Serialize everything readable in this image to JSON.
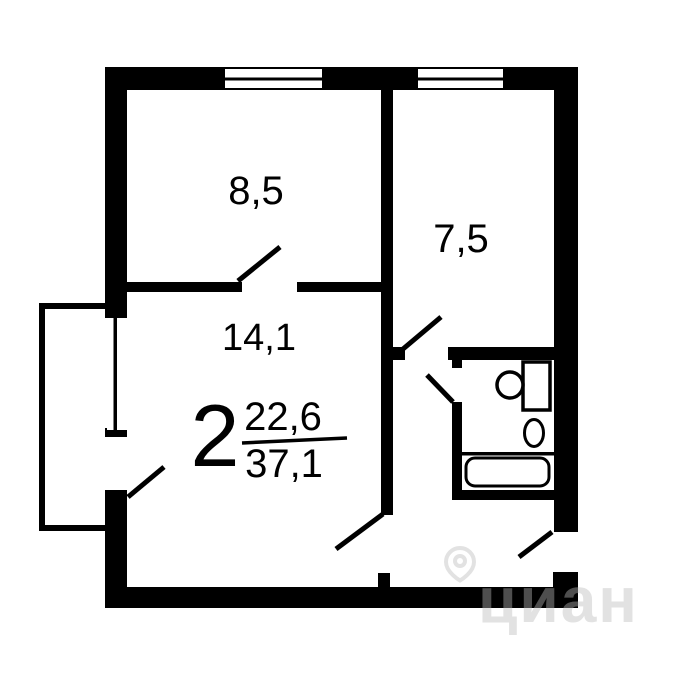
{
  "plan": {
    "rooms_count": "2",
    "living_area": "22,6",
    "total_area": "37,1",
    "rooms": [
      {
        "id": "room-top-left",
        "area": "8,5"
      },
      {
        "id": "room-top-right",
        "area": "7,5"
      },
      {
        "id": "room-main",
        "area": "14,1"
      }
    ]
  },
  "fixtures": [
    {
      "name": "bathtub"
    },
    {
      "name": "sink"
    },
    {
      "name": "toilet"
    },
    {
      "name": "balcony"
    }
  ],
  "watermark": {
    "text": "циан",
    "icon": "map-pin-icon"
  },
  "colors": {
    "wall": "#000000",
    "background": "#ffffff",
    "watermark": "rgba(185,185,185,0.42)"
  }
}
